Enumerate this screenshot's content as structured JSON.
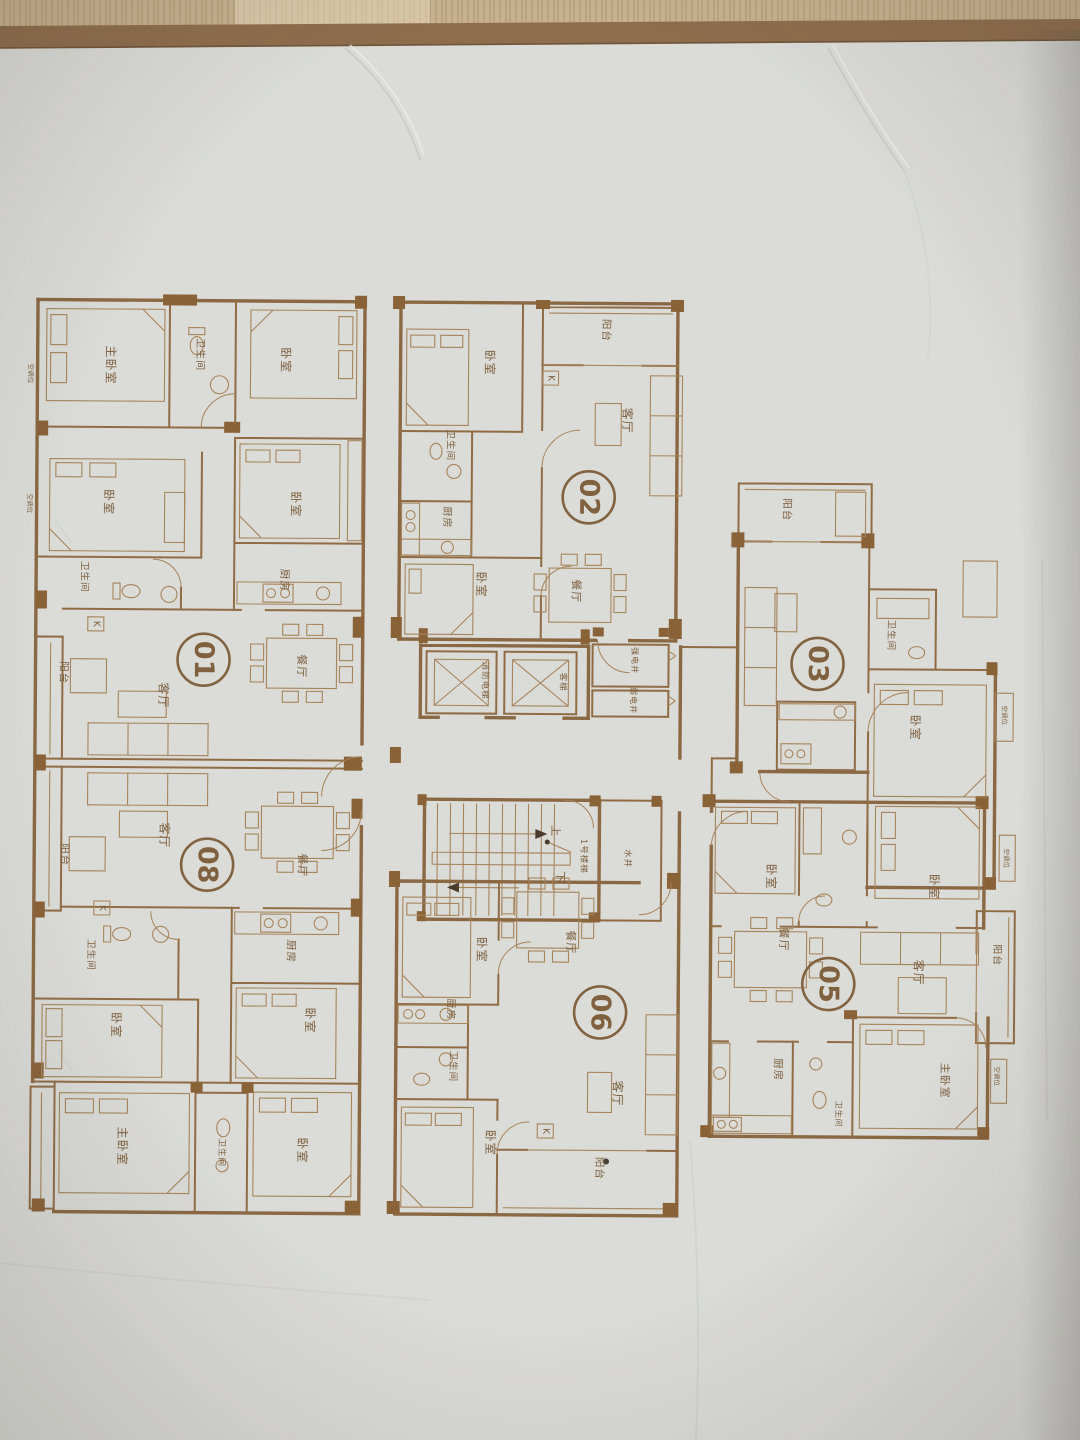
{
  "colors": {
    "paper": "#dbdcd8",
    "ink": "#8a6843",
    "wall_fill": "#8a6238",
    "wood_top": "#c6b190",
    "paper_edge_band": "#8e6d4d"
  },
  "plan": {
    "units": [
      {
        "id": "01",
        "x": 203,
        "y": 662
      },
      {
        "id": "02",
        "x": 587,
        "y": 497
      },
      {
        "id": "03",
        "x": 817,
        "y": 662
      },
      {
        "id": "05",
        "x": 830,
        "y": 982
      },
      {
        "id": "06",
        "x": 602,
        "y": 1012
      },
      {
        "id": "08",
        "x": 208,
        "y": 867
      }
    ],
    "labels": [
      {
        "t": "主卧室",
        "x": 108,
        "y": 368,
        "s": 12
      },
      {
        "t": "卫生间",
        "x": 197,
        "y": 357,
        "s": 10
      },
      {
        "t": "卧室",
        "x": 283,
        "y": 362,
        "s": 12
      },
      {
        "t": "卧室",
        "x": 107,
        "y": 505,
        "s": 12
      },
      {
        "t": "卧室",
        "x": 294,
        "y": 506,
        "s": 12
      },
      {
        "t": "厨房",
        "x": 283,
        "y": 582,
        "s": 10.5
      },
      {
        "t": "卫生间",
        "x": 83,
        "y": 580,
        "s": 9.5
      },
      {
        "t": "餐厅",
        "x": 301,
        "y": 668,
        "s": 11
      },
      {
        "t": "客厅",
        "x": 163,
        "y": 698,
        "s": 12
      },
      {
        "t": "阳台",
        "x": 63,
        "y": 676,
        "s": 10.5
      },
      {
        "t": "卧室",
        "x": 487,
        "y": 363,
        "s": 12
      },
      {
        "t": "阳台",
        "x": 603,
        "y": 330,
        "s": 10.5
      },
      {
        "t": "卫生间",
        "x": 448,
        "y": 446,
        "s": 9.5
      },
      {
        "t": "厨房",
        "x": 445,
        "y": 518,
        "s": 10
      },
      {
        "t": "客厅",
        "x": 625,
        "y": 420,
        "s": 12
      },
      {
        "t": "餐厅",
        "x": 575,
        "y": 591,
        "s": 11
      },
      {
        "t": "卧室",
        "x": 480,
        "y": 585,
        "s": 12
      },
      {
        "t": "消防电梯",
        "x": 484,
        "y": 681,
        "s": 8.5
      },
      {
        "t": "客梯",
        "x": 562,
        "y": 682,
        "s": 8.5
      },
      {
        "t": "强电井",
        "x": 634,
        "y": 660,
        "s": 8
      },
      {
        "t": "弱电井",
        "x": 633,
        "y": 700,
        "s": 8
      },
      {
        "t": "上",
        "x": 556,
        "y": 831,
        "s": 11
      },
      {
        "t": "下",
        "x": 561,
        "y": 877,
        "s": 11
      },
      {
        "t": "1号楼梯",
        "x": 584,
        "y": 856,
        "s": 8.5
      },
      {
        "t": "水井",
        "x": 628,
        "y": 858,
        "s": 8.5
      },
      {
        "t": "阳台",
        "x": 785,
        "y": 508,
        "s": 10.5
      },
      {
        "t": "卫生间",
        "x": 890,
        "y": 633,
        "s": 9.5
      },
      {
        "t": "卧室",
        "x": 915,
        "y": 725,
        "s": 12
      },
      {
        "t": "卧室",
        "x": 772,
        "y": 875,
        "s": 12
      },
      {
        "t": "卧室",
        "x": 935,
        "y": 884,
        "s": 12
      },
      {
        "t": "餐厅",
        "x": 785,
        "y": 938,
        "s": 11
      },
      {
        "t": "客厅",
        "x": 920,
        "y": 970,
        "s": 12
      },
      {
        "t": "阳台",
        "x": 998,
        "y": 952,
        "s": 10
      },
      {
        "t": "厨房",
        "x": 780,
        "y": 1068,
        "s": 10.5
      },
      {
        "t": "卫生间",
        "x": 841,
        "y": 1112,
        "s": 8
      },
      {
        "t": "主卧室",
        "x": 947,
        "y": 1078,
        "s": 11
      },
      {
        "t": "卧室",
        "x": 483,
        "y": 950,
        "s": 12
      },
      {
        "t": "餐厅",
        "x": 572,
        "y": 942,
        "s": 11
      },
      {
        "t": "厨房",
        "x": 452,
        "y": 1010,
        "s": 10
      },
      {
        "t": "卫生间",
        "x": 455,
        "y": 1067,
        "s": 9.5
      },
      {
        "t": "卧室",
        "x": 493,
        "y": 1143,
        "s": 12
      },
      {
        "t": "客厅",
        "x": 620,
        "y": 1093,
        "s": 12
      },
      {
        "t": "阳台",
        "x": 602,
        "y": 1168,
        "s": 10.5
      },
      {
        "t": "客厅",
        "x": 165,
        "y": 838,
        "s": 12
      },
      {
        "t": "餐厅",
        "x": 303,
        "y": 867,
        "s": 11
      },
      {
        "t": "阳台",
        "x": 65,
        "y": 858,
        "s": 10.5
      },
      {
        "t": "卫生间",
        "x": 92,
        "y": 958,
        "s": 9.5
      },
      {
        "t": "厨房",
        "x": 292,
        "y": 953,
        "s": 10.5
      },
      {
        "t": "卧室",
        "x": 118,
        "y": 1028,
        "s": 12
      },
      {
        "t": "卧室",
        "x": 312,
        "y": 1022,
        "s": 12
      },
      {
        "t": "主卧室",
        "x": 125,
        "y": 1149,
        "s": 12
      },
      {
        "t": "卫生间",
        "x": 224,
        "y": 1155,
        "s": 8.5
      },
      {
        "t": "卧室",
        "x": 305,
        "y": 1152,
        "s": 12
      }
    ],
    "k_markers": [
      {
        "t": "K",
        "x": 95,
        "y": 627
      },
      {
        "t": "K",
        "x": 548,
        "y": 378
      },
      {
        "t": "K",
        "x": 548,
        "y": 1131
      },
      {
        "t": "K",
        "x": 103,
        "y": 911
      }
    ],
    "ac_tags": [
      {
        "t": "空调位",
        "x": 28,
        "y": 377
      },
      {
        "t": "空调位",
        "x": 28,
        "y": 507
      },
      {
        "t": "空调位",
        "x": 1004,
        "y": 712
      },
      {
        "t": "空调位",
        "x": 1007,
        "y": 855
      },
      {
        "t": "空调位",
        "x": 999,
        "y": 1073
      }
    ]
  }
}
